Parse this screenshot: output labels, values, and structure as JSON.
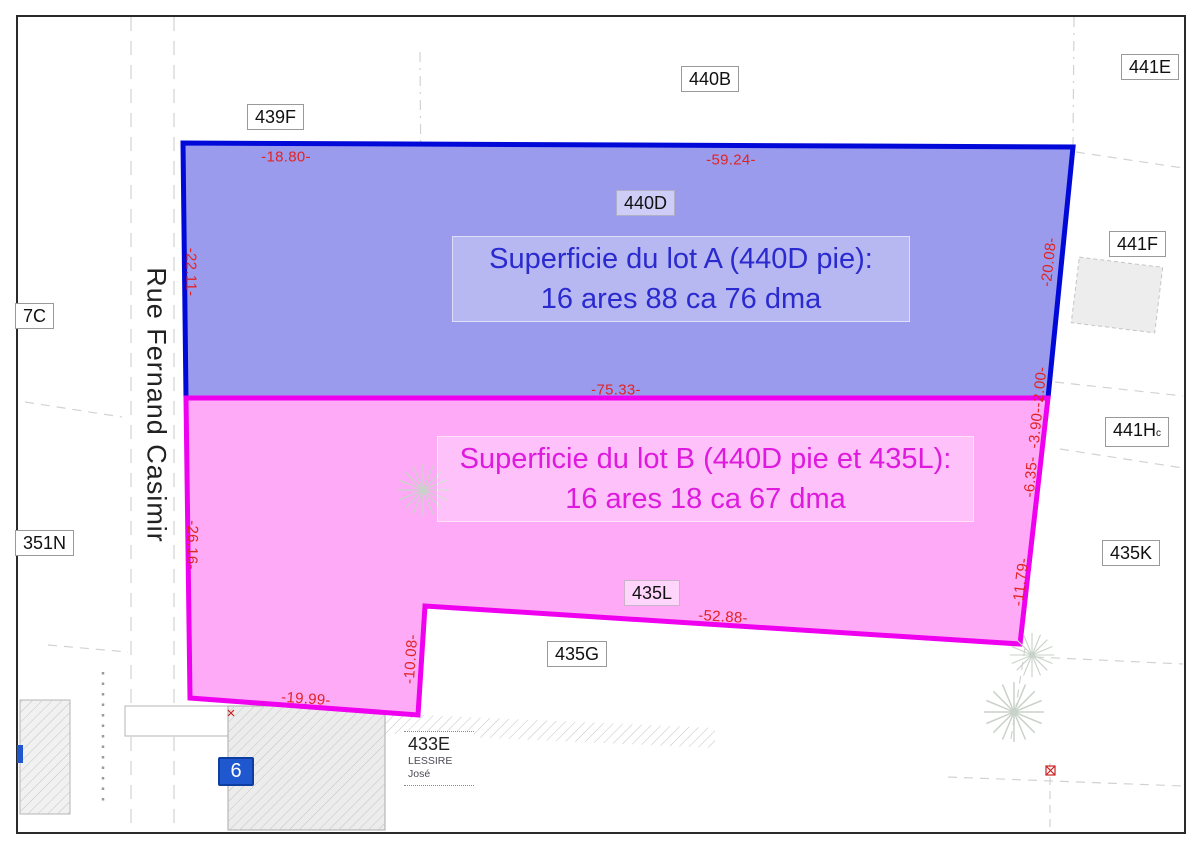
{
  "street": {
    "name": "Rue Fernand Casimir"
  },
  "lot_a": {
    "label_line1": "Superficie du lot A (440D pie):",
    "label_line2": "16 ares 88 ca 76 dma",
    "fill": "#9b9bee",
    "stroke": "#0009d8",
    "text_color": "#2a2ace"
  },
  "lot_b": {
    "label_line1": "Superficie du lot B (440D pie et 435L):",
    "label_line2": "16 ares 18 ca 67 dma",
    "fill": "#feaaf7",
    "stroke": "#ef00ef",
    "text_color": "#dd1add"
  },
  "parcels": [
    {
      "label": "439F"
    },
    {
      "label": "440B"
    },
    {
      "label": "441E"
    },
    {
      "label": "440D"
    },
    {
      "label": "441F"
    },
    {
      "label": "441H",
      "sub": "c"
    },
    {
      "label": "435K"
    },
    {
      "label": "435L"
    },
    {
      "label": "435G"
    },
    {
      "label": "351N"
    },
    {
      "label": "7C"
    }
  ],
  "owner_parcel": {
    "label": "433E",
    "owner_line1": "LESSIRE",
    "owner_line2": "José"
  },
  "house_number": "6",
  "dimensions": [
    {
      "value": "-18.80-"
    },
    {
      "value": "-59.24-"
    },
    {
      "value": "-22.11-"
    },
    {
      "value": "-20.08-"
    },
    {
      "value": "-75.33-"
    },
    {
      "value": "-2.00-"
    },
    {
      "value": "-3.90-"
    },
    {
      "value": "-6.35-"
    },
    {
      "value": "-11.79-"
    },
    {
      "value": "-26.16-"
    },
    {
      "value": "-52.88-"
    },
    {
      "value": "-10.08-"
    },
    {
      "value": "-19.99-"
    }
  ],
  "colors": {
    "dimension_red": "#e02424",
    "badge_blue": "#1f57cf",
    "frame_black": "#2a2a2a"
  }
}
